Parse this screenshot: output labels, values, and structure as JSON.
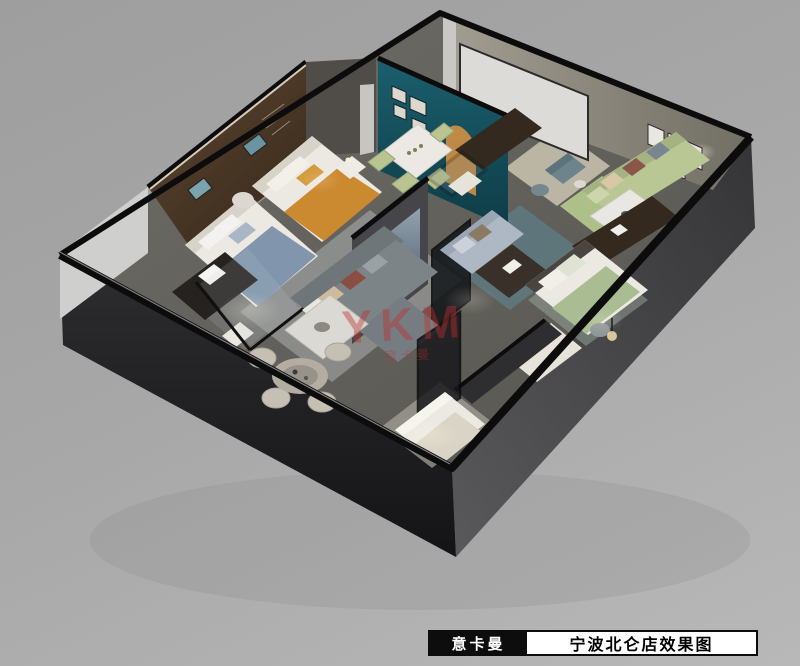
{
  "footer": {
    "brand": "意卡曼",
    "title": "宁波北仑店效果图"
  },
  "watermark": {
    "main": "YKM",
    "sub": "意卡曼"
  },
  "palette": {
    "bg-top": "#9e9e9e",
    "bg-bottom": "#b8b8b8",
    "wall-edge": "#0c0c0d",
    "wall-front": "#232325",
    "wall-side": "#3e3e41",
    "wall-back": "#8f8b80",
    "floor": "#64625d",
    "wood": "#4a3728",
    "teal": "#15525f",
    "screen-white": "#dcdbd7",
    "sofa-green": "#b9c795",
    "sofa-gray": "#7d8488",
    "sofa-blue": "#aeb8c4",
    "bed-white": "#ebe9e2",
    "accent-orange": "#cc8a30",
    "throw-blue": "#8195ad",
    "rug": "#b4b7b8",
    "watermark-red": "#c03030",
    "footer-bg": "#0d0d0d",
    "footer-fg": "#ffffff"
  }
}
